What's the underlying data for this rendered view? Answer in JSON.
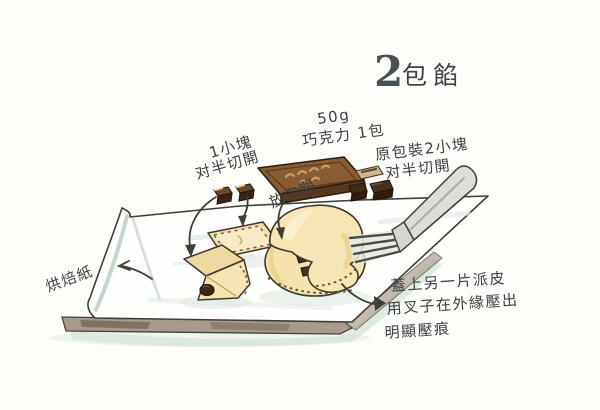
{
  "title": {
    "number": "2",
    "label": "包餡"
  },
  "labels": {
    "chocolate_pack_line1": "50g",
    "chocolate_pack_line2": "巧克力 1包",
    "one_piece_line1": "1小塊",
    "one_piece_line2": "对半切開",
    "original_pack_line1": "原包裝2小塊",
    "original_pack_line2": "对半切開",
    "place_center": "放中間",
    "baking_paper": "烘焙紙",
    "cover_line1": "蓋上另一片派皮",
    "cover_line2": "用叉子在外緣壓出",
    "cover_line3": "明顯壓痕"
  },
  "colors": {
    "ink": "#3f3e39",
    "text_ink": "#3b4043",
    "pastry": "#f3e0a8",
    "pastry_light": "#fbf1d0",
    "chocolate_dark": "#422b16",
    "chocolate_bar_top": "#8a5c32",
    "chocolate_bar_letters": "#c99c5e",
    "paper_shade": "#c9d6d0",
    "board": "#a89b8d",
    "shadow_green": "#d8e5dd",
    "fork": "#dcded9"
  }
}
